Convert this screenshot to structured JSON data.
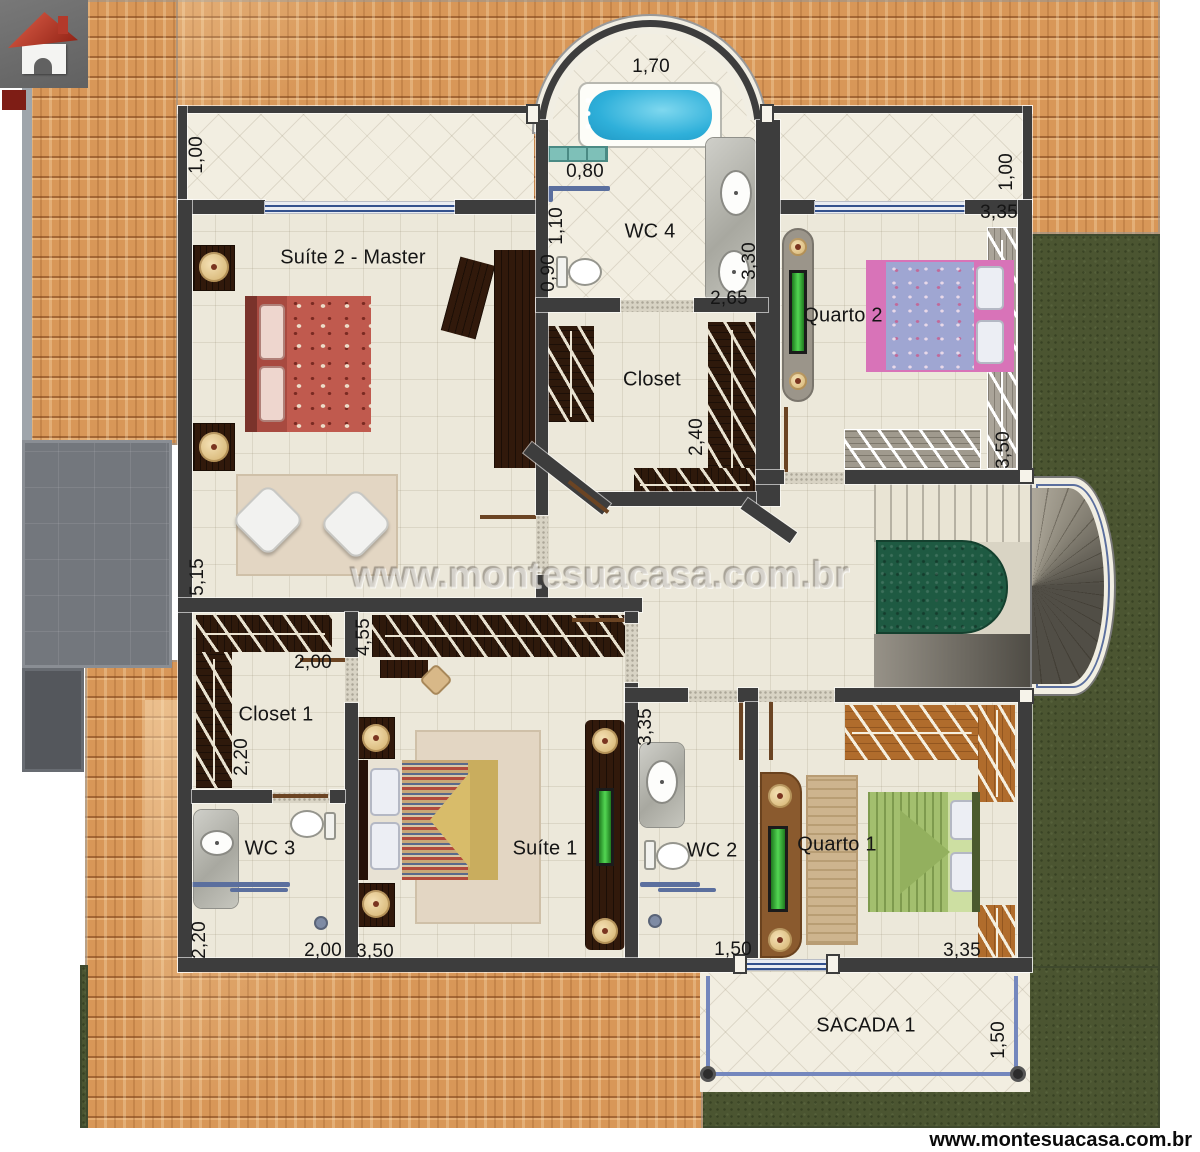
{
  "watermark": {
    "text": "www.montesuacasa.com.br"
  },
  "footer": {
    "url": "www.montesuacasa.com.br"
  },
  "rooms": {
    "suite2": {
      "label": "Suíte 2 - Master"
    },
    "wc4": {
      "label": "WC 4"
    },
    "quarto2": {
      "label": "Quarto 2"
    },
    "closet": {
      "label": "Closet"
    },
    "closet1": {
      "label": "Closet 1"
    },
    "wc3": {
      "label": "WC 3"
    },
    "suite1": {
      "label": "Suíte 1"
    },
    "wc2": {
      "label": "WC 2"
    },
    "quarto1": {
      "label": "Quarto 1"
    },
    "sacada1": {
      "label": "SACADA 1"
    }
  },
  "dims": {
    "terrace_left": "1,00",
    "terrace_right": "1,00",
    "tub_width": "1,70",
    "wc4_shower_width": "0,80",
    "wc4_depth_a": "1,10",
    "wc4_depth_b": "0,90",
    "wc4_width": "2,65",
    "wc4_height": "3,30",
    "quarto2_width": "3,35",
    "quarto2_height": "3,50",
    "closet_depth": "2,40",
    "suite2_height": "5,15",
    "closet1_width": "2,00",
    "closet1_height": "2,20",
    "suite1_wardrobe": "4,55",
    "wc3_height": "2,20",
    "wc3_width": "2,00",
    "suite1_width": "3,50",
    "wc2_height": "3,35",
    "wc2_width": "1,50",
    "quarto1_width": "3,35",
    "sacada_depth": "1,50"
  },
  "colors": {
    "wall": "#3d3d3d",
    "roof": "#d89758",
    "grass": "#4b5531",
    "tub_water": "#2fb0da",
    "stair_void": "#1e5a42",
    "wood_dark": "#31190b"
  }
}
